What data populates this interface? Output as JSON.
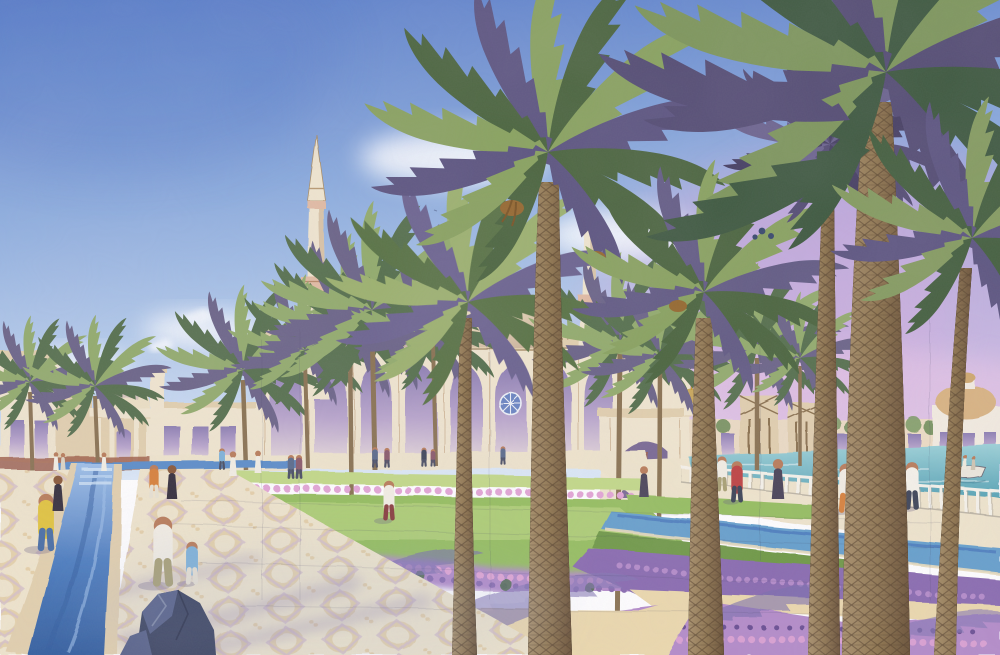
{
  "description": "Watercolor architectural rendering of a grand mosque complex: a large cream dome with gold finial flanked by two slender minarets, a long arcaded portico, rows of date palms, formal gardens with lavender and pink flower beds, a blue reflecting-water channel running through patterned stone paving, a waterfront promenade with white railing and a small boat, and many small strolling figures under a blue sky that fades to violet-pink on the right.",
  "medium": "watercolor and ink architectural illustration",
  "scene": {
    "regions": [
      "sky-with-clouds",
      "left-minaret",
      "right-minaret",
      "central-dome",
      "arcaded-portico",
      "left-domed-pavilion",
      "left-colonnade",
      "right-gateway",
      "wind-tower-buildings",
      "far-domed-pavilion",
      "waterfront-basin",
      "boat",
      "promenade-railing",
      "reflecting-channel",
      "patterned-walkways",
      "lawns",
      "flower-beds",
      "sand-path-with-frond-shadows",
      "foreground-rock",
      "date-palms",
      "pedestrians"
    ]
  },
  "figures": [
    {
      "name": "yellow-shirt-walker",
      "top": "#e2c53e",
      "bottom": "#4a6fa5"
    },
    {
      "name": "father-with-child",
      "top": "#e9e4d8",
      "bottom": "#a9a174"
    },
    {
      "name": "child-blue-shirt",
      "top": "#7fb3d9",
      "bottom": "#e8e2d2"
    },
    {
      "name": "orange-shirt-walker",
      "top": "#d8823b",
      "bottom": "#e8e2d2"
    },
    {
      "name": "black-abaya-figure",
      "top": "#36303d",
      "bottom": "#36303d"
    },
    {
      "name": "garden-stroller",
      "top": "#f3efe4",
      "bottom": "#8a4040"
    },
    {
      "name": "red-jacket-walker",
      "top": "#bf4343",
      "bottom": "#3e4558"
    },
    {
      "name": "railing-leaner",
      "top": "#f3f2ee",
      "bottom": "#3e4558"
    },
    {
      "name": "white-robe-figures",
      "top": "#f3efe4",
      "bottom": "#f3efe4"
    }
  ],
  "palette": {
    "sky_top": "#5c80ca",
    "sky_mid": "#8fafdf",
    "sky_light": "#dce9f7",
    "cloud": "#f8fbfe",
    "sky_pink": "#d6aede",
    "sky_magenta": "#c897d4",
    "sky_pink_low": "#ecc8e6",
    "cream": "#f0e6cf",
    "cream_dark": "#e2d0ae",
    "tan_shade": "#c9ad8a",
    "purple_shade": "#a08abc",
    "arch_top": "#8d7fb2",
    "arch_mid": "#b9a6cc",
    "arch_low": "#e6d9da",
    "red_base": "#a0624a",
    "dome_cream": "#ece0c4",
    "dome_shade": "#c4aab8",
    "gold": "#c2992e",
    "minaret_pink": "#e2bca4",
    "palm_main": "#57714e",
    "palm_light": "#93ac6d",
    "palm_shadow": "#6c6588",
    "palm_olive": "#7d8a55",
    "trunk_light": "#a08a62",
    "trunk_dark": "#6e5a40",
    "trunk_line": "#55432e",
    "frond_brown": "#96692f",
    "water_light": "#8fb2e0",
    "water_deep": "#3f6db5",
    "teal_light": "#8fc9d3",
    "teal_deep": "#4f9cb3",
    "lawn_light": "#c3da88",
    "lawn_mid": "#96bf60",
    "lawn_deep": "#6f9a46",
    "flower_pink": "#e3a6d5",
    "flower_purple": "#b48cc9",
    "flower_deep": "#8a6cb0",
    "flower_dark": "#6a4f93",
    "sand": "#ecd9ad",
    "sand_dark": "#d9c28c",
    "pave": "#efe5cc",
    "pave_tan": "#d9b77f",
    "pave_mauve": "#bb9cc6",
    "shadow_purple": "#8577ad",
    "rock_dark": "#39415c",
    "rock_mid": "#566086",
    "rock_light": "#8a93ad",
    "skin": "#b97d5a",
    "rail_white": "#f6f3ea",
    "shirt_yellow": "#e2c53e",
    "jeans": "#4a6fa5",
    "khaki": "#a9a174",
    "child_blue": "#7fb3d9",
    "orange": "#d8823b",
    "abaya": "#36303d",
    "red_jacket": "#bf4343",
    "maroon": "#8a4040",
    "white_cloth": "#f3efe4",
    "navy": "#3e4558",
    "slate": "#5a6b8a",
    "plum": "#8a5a6a",
    "dusk": "#4a4458"
  }
}
